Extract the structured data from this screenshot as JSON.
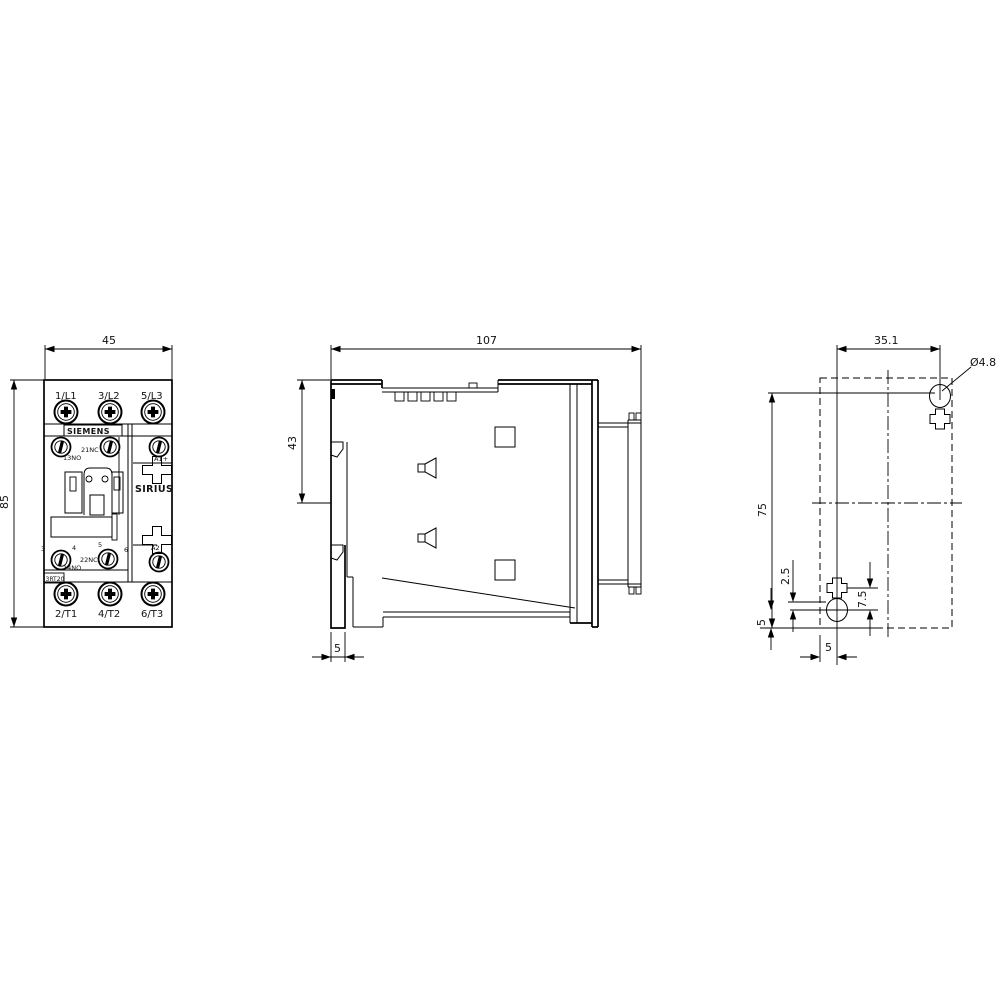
{
  "palette": {
    "line": "#000000",
    "background": "#ffffff"
  },
  "views": {
    "front": {
      "width_dim": "45",
      "height_dim": "85",
      "brand": "SIEMENS",
      "series": "SIRIUS",
      "type_label": "3RT20",
      "terminals_top": [
        "1/L1",
        "3/L2",
        "5/L3"
      ],
      "terminals_bottom": [
        "2/T1",
        "4/T2",
        "6/T3"
      ],
      "aux": {
        "no13": "13NO",
        "nc21": "21NC",
        "a1": "A1+",
        "t3": "3",
        "t4": "4",
        "t5": "5",
        "t6": "6",
        "nc22": "22NC",
        "no14": "14NO",
        "a2": "A2"
      }
    },
    "side": {
      "depth_dim": "107",
      "rail_height_dim": "43",
      "rail_depth_dim": "5"
    },
    "drill": {
      "hole_spacing_x": "35.1",
      "hole_diameter": "Ø4.8",
      "hole_spacing_y": "75",
      "offset_small": "2.5",
      "offset_slot": "7.5",
      "offset_bottom": "5",
      "offset_side": "5"
    }
  }
}
